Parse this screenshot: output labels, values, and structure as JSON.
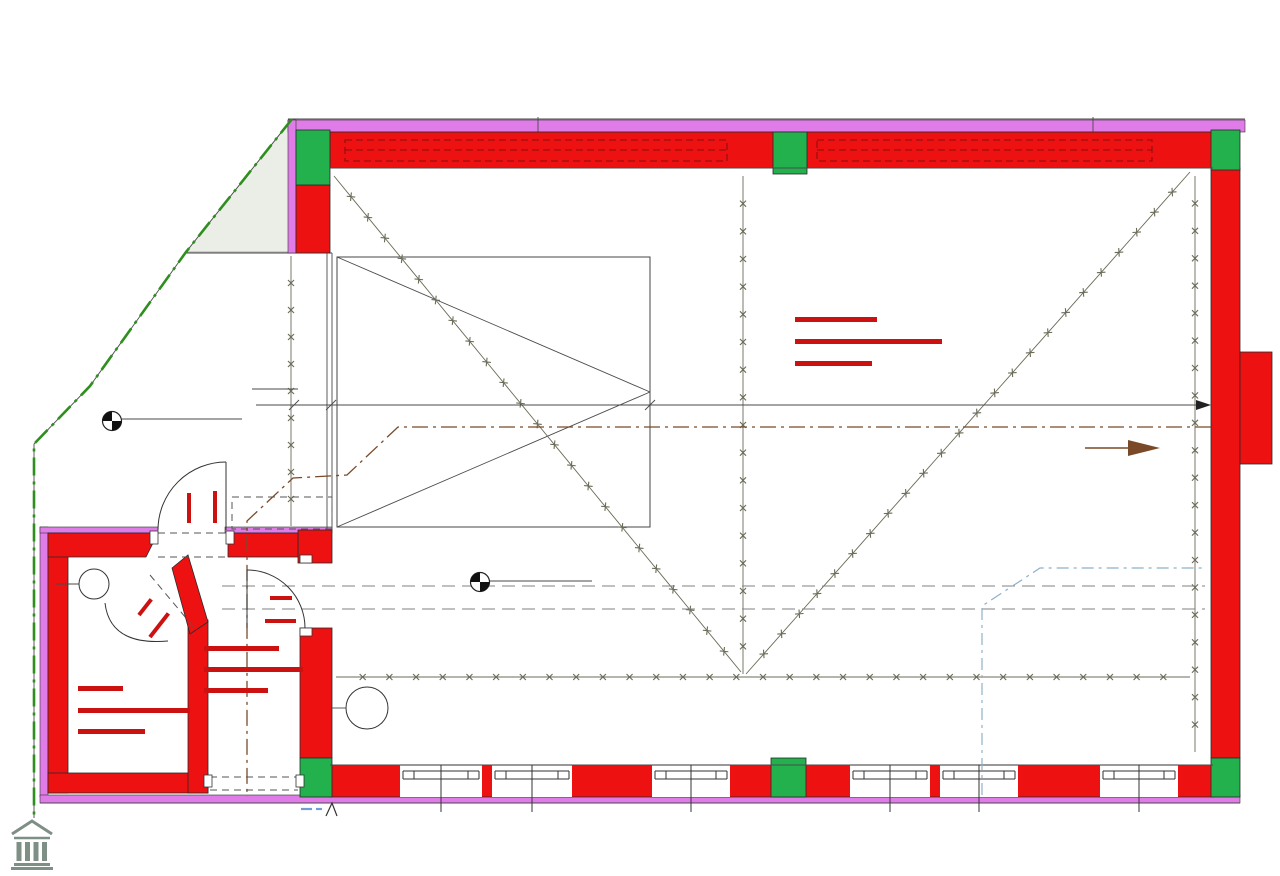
{
  "title": "Top 1 - Erdgeschoss",
  "plan": {
    "rooms": {
      "lager": {
        "name": "LAGER",
        "construction": "MONOLITHPLATTE",
        "area": "82.10m²"
      },
      "gang": {
        "name": "GANG",
        "construction": "MONOLITHPL.",
        "area": "3.76m²"
      },
      "ar": {
        "name": "AR",
        "construction": "MONOLITHPL.",
        "area": "3.87m²"
      }
    },
    "levels": {
      "street": {
        "label": "OK STRASSE",
        "value": "-0,15"
      },
      "floor": {
        "label": "FOK=RDOK",
        "value": "±0,00"
      }
    },
    "heights": {
      "top": "PH=320",
      "bottom": "PH=240"
    },
    "dims": {
      "d335": "335",
      "d400": "400",
      "d46": "46",
      "d393": "393",
      "d703": "703",
      "partial_right": "3"
    },
    "doors": {
      "entrance": {
        "w": "100",
        "h": "200"
      },
      "ar": {
        "w": "80",
        "h": "200"
      },
      "gang": {
        "w": "90",
        "h": "200"
      }
    },
    "markers": {
      "window": "W1",
      "door": "TW1"
    },
    "notes": {
      "parking": "10 Stellplätze",
      "sewer": "SW PVC#150 1,5%"
    }
  },
  "footer": {
    "brand": "PRADIUM",
    "brand_sub": "IMMOBILIEN GMBH"
  },
  "colors": {
    "wall_red": "#ee1111",
    "column_green": "#22b14c",
    "insulation_magenta": "#e07ce8",
    "boundary_green": "#2e8f1e",
    "annotation_red": "#cc1111",
    "sewer_brown": "#7a4a28",
    "drain_blue": "#8fb0c8",
    "brand_gray": "#7e8f86"
  }
}
